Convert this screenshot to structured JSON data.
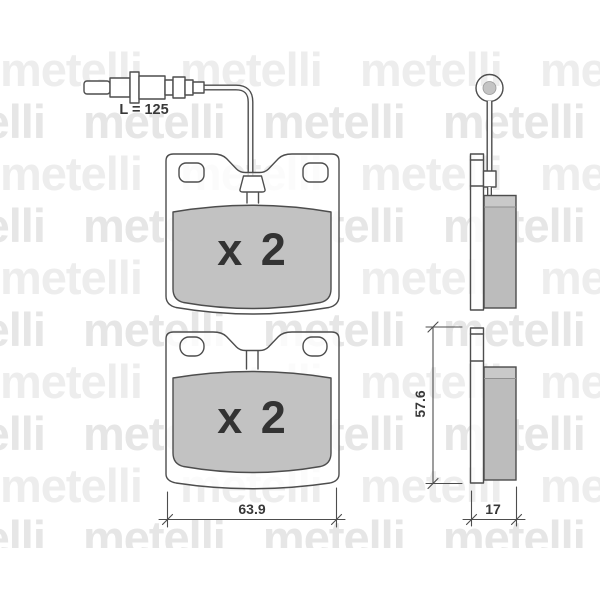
{
  "watermark": {
    "word": "metelli",
    "row_text": "metelli metelli metelli metelli"
  },
  "colors": {
    "line": "#4d4d4d",
    "friction_front": "#c2c2c2",
    "friction_side": "#bcbcbc",
    "watermark_light": "#ededed",
    "watermark_dark": "#e6e6e6",
    "text": "#383838"
  },
  "labels": {
    "sensor_length": "L = 125",
    "quantity_top": "x 2",
    "quantity_bottom": "x 2",
    "pad_width": "63.9",
    "pad_height": "57.6",
    "pad_thickness": "17"
  }
}
